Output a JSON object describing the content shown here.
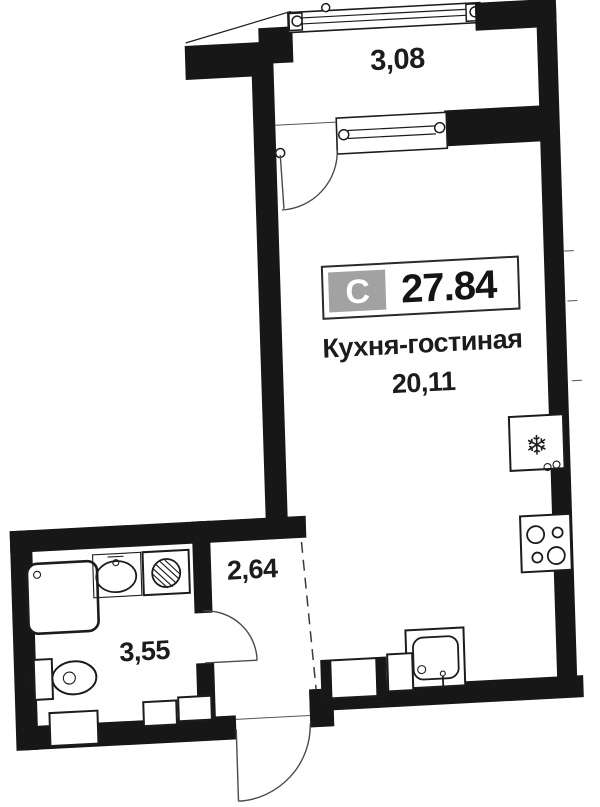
{
  "plan": {
    "badge": {
      "type_label": "С",
      "total_area": "27.84"
    },
    "rooms": [
      {
        "id": "balcony",
        "area": "3,08"
      },
      {
        "id": "kitchen-living",
        "name": "Кухня-гостиная",
        "area": "20,11"
      },
      {
        "id": "hallway",
        "area": "2,64"
      },
      {
        "id": "bathroom",
        "area": "3,55"
      }
    ],
    "icons": {
      "fridge": "❄"
    },
    "colors": {
      "wall": "#171717",
      "badge_bg": "#a2a2a2",
      "text": "#1c1c1c"
    }
  }
}
